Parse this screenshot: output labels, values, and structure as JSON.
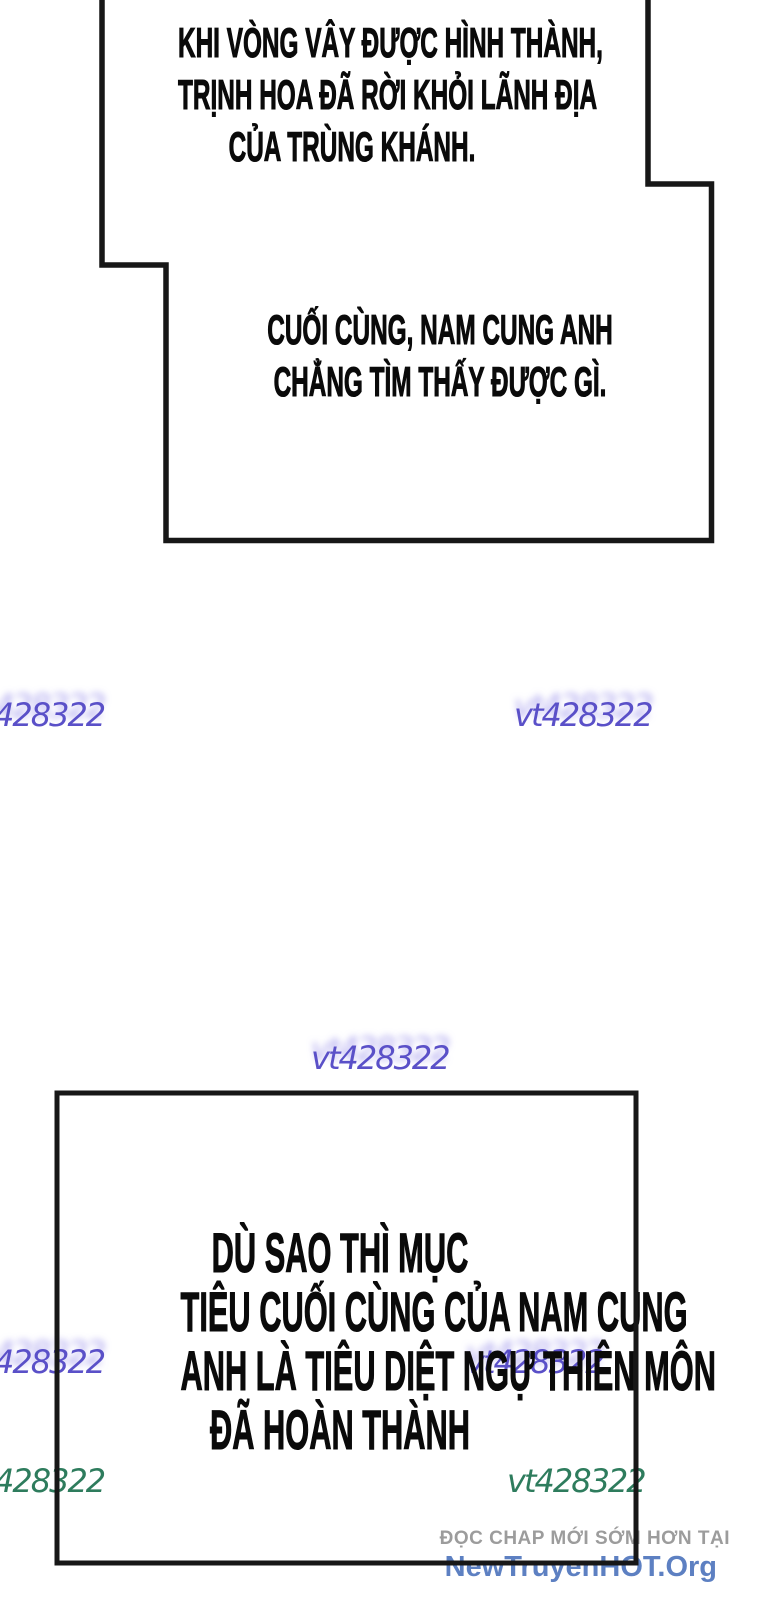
{
  "comic": {
    "top_panel": {
      "caption1": {
        "lines": [
          "KHI VÒNG VÂY ĐƯỢC HÌNH THÀNH,",
          "TRỊNH HOA ĐÃ RỜI KHỎI LÃNH ĐỊA",
          "CỦA TRÙNG KHÁNH."
        ]
      },
      "caption2": {
        "lines": [
          "CUỐI CÙNG, NAM CUNG ANH",
          "CHẲNG TÌM THẤY ĐƯỢC GÌ."
        ]
      }
    },
    "bottom_panel": {
      "caption": {
        "lines": [
          "DÙ SAO THÌ MỤC",
          "TIÊU CUỐI CÙNG CỦA NAM CUNG",
          "ANH LÀ TIÊU DIỆT NGỰ THIÊN MÔN",
          "ĐÃ HOÀN THÀNH"
        ]
      }
    }
  },
  "watermarks": {
    "purple_color": "#5a50c8",
    "green_color": "#2e7c5d",
    "row1_left": "428322",
    "row1_right": "vt428322",
    "center": "vt428322",
    "mid_left": "428322",
    "mid_right": "vt428322",
    "bottom_left": "428322",
    "bottom_right": "vt428322"
  },
  "footer": {
    "promo_line": "ĐỌC CHAP MỚI SỚM HƠN TẠI",
    "promo_color": "#9c9c9c",
    "site_name": "NewTruyenHOT.Org",
    "site_color": "#5d80c2"
  }
}
